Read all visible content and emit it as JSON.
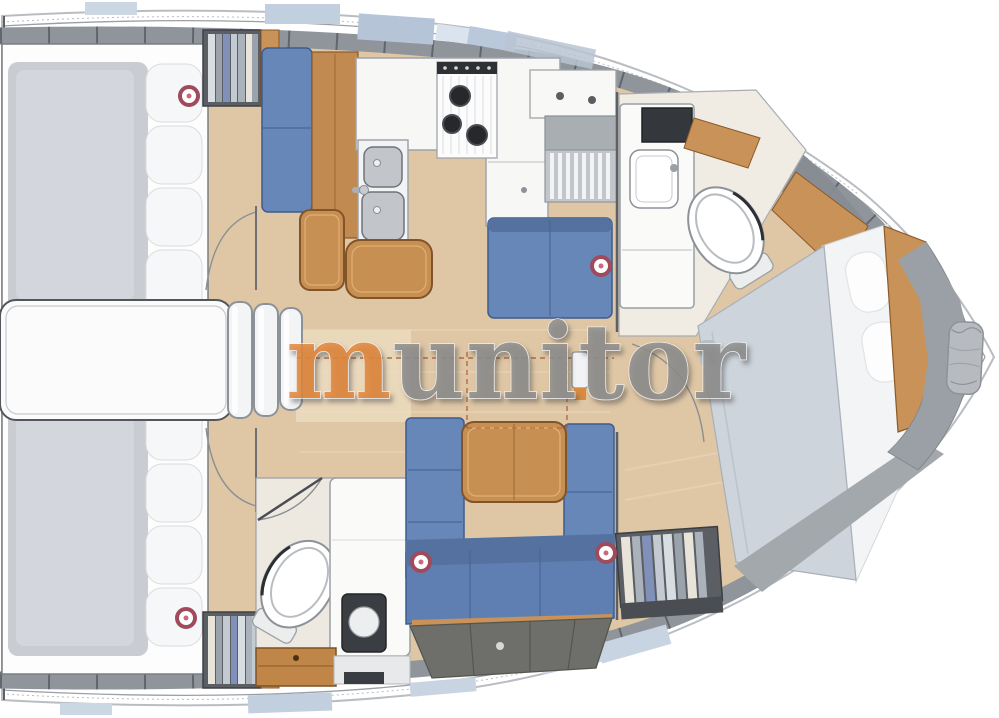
{
  "watermark": {
    "prefix": "m",
    "suffix": "unitor",
    "full_text": "munitor"
  },
  "palette": {
    "hull_white": "#ffffff",
    "hull_edge": "#b9bdc2",
    "deck_band_gray": "#8f959b",
    "deck_tick_gray": "#61666c",
    "hatch_blue": "#c2cfdf",
    "floor_wood": "#dfc7a5",
    "floor_light": "#ecdcc0",
    "cabinet_wood": "#c88f53",
    "wood_edge": "#82542a",
    "upholstery_blue": "#6787b8",
    "upholstery_blue_dark": "#54719f",
    "upholstery_edge": "#3d5c90",
    "mattress_gray": "#c9cdd2",
    "pillow_white": "#f6f7f8",
    "duvet_gray": "#cdd4dc",
    "locker_gray": "#6e6f6a",
    "bow_gray": "#9aa0a6",
    "wardrobe_frame": "#5b5f64",
    "appliance_dark": "#34383d",
    "portlight_red": "#a04b5c",
    "dashed_line": "#a85c38",
    "watermark_gray": "#8e8e8e",
    "watermark_orange": "#e2873b"
  }
}
